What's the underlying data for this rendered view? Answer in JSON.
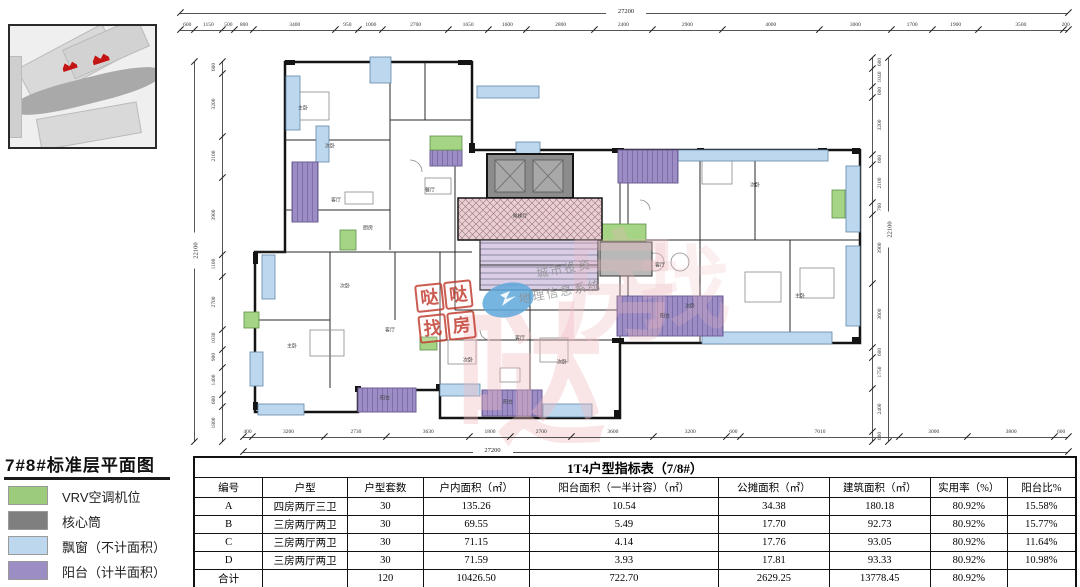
{
  "legend": {
    "title": "7#8#标准层平面图",
    "items": [
      {
        "label": "VRV空调机位",
        "color": "#9CCB7B"
      },
      {
        "label": "核心筒",
        "color": "#7F7F7F"
      },
      {
        "label": "飘窗（不计面积）",
        "color": "#BDD7EE"
      },
      {
        "label": "阳台（计半面积）",
        "color": "#9C8EC4"
      }
    ]
  },
  "site_map": {
    "highlight_color": "#c41414"
  },
  "plan": {
    "colors": {
      "bay_window": "#BDD7EE",
      "balcony": "#9C8EC4",
      "vrv": "#A5D484",
      "core": "#8C8C8C",
      "wall": "#141414",
      "hall_hatch": "#E9CFD3"
    },
    "dimensions": {
      "top": {
        "total": "27200",
        "segments": [
          "600",
          "1150",
          "500",
          "800",
          "3400",
          "950",
          "1000",
          "2700",
          "1650",
          "1600",
          "2800",
          "2400",
          "2900",
          "4000",
          "3000",
          "1700",
          "1900",
          "3500",
          "200"
        ]
      },
      "bottom": {
        "total": "27200",
        "segments": [
          "400",
          "3200",
          "2730",
          "3630",
          "1800",
          "2700",
          "3600",
          "3200",
          "600",
          "7010",
          "3000",
          "3800",
          "600"
        ]
      },
      "left": {
        "total": "22100",
        "segments": [
          "600",
          "3200",
          "2100",
          "3900",
          "1100",
          "2700",
          "1030",
          "900",
          "1400",
          "600",
          "1800"
        ]
      },
      "right": {
        "total": "22100",
        "segments": [
          "600",
          "1040",
          "600",
          "3200",
          "600",
          "2100",
          "700",
          "3900",
          "3600",
          "600",
          "1750",
          "2400",
          "600"
        ]
      }
    },
    "room_labels": [
      {
        "t": "主卧",
        "x": 303,
        "y": 108
      },
      {
        "t": "次卧",
        "x": 330,
        "y": 146
      },
      {
        "t": "客厅",
        "x": 336,
        "y": 200
      },
      {
        "t": "厨房",
        "x": 368,
        "y": 228
      },
      {
        "t": "餐厅",
        "x": 430,
        "y": 190
      },
      {
        "t": "候梯厅",
        "x": 520,
        "y": 216
      },
      {
        "t": "次卧",
        "x": 755,
        "y": 185
      },
      {
        "t": "客厅",
        "x": 660,
        "y": 265
      },
      {
        "t": "次卧",
        "x": 690,
        "y": 306
      },
      {
        "t": "主卧",
        "x": 800,
        "y": 296
      },
      {
        "t": "阳台",
        "x": 665,
        "y": 316
      },
      {
        "t": "主卧",
        "x": 292,
        "y": 346
      },
      {
        "t": "次卧",
        "x": 345,
        "y": 286
      },
      {
        "t": "客厅",
        "x": 390,
        "y": 330
      },
      {
        "t": "次卧",
        "x": 468,
        "y": 360
      },
      {
        "t": "客厅",
        "x": 520,
        "y": 338
      },
      {
        "t": "次卧",
        "x": 562,
        "y": 362
      },
      {
        "t": "阳台",
        "x": 385,
        "y": 398
      },
      {
        "t": "阳台",
        "x": 508,
        "y": 402
      }
    ],
    "watermarks": {
      "stamp_chars": [
        "哒",
        "哒",
        "找",
        "房"
      ],
      "gis_line1": "城市投资",
      "gis_line2": "地理信息系统"
    }
  },
  "table": {
    "title": "1T4户型指标表（7/8#）",
    "headers": [
      "编号",
      "户型",
      "户型套数",
      "户内面积（㎡）",
      "阳台面积（一半计容）（㎡）",
      "公摊面积（㎡）",
      "建筑面积（㎡）",
      "实用率（%）",
      "阳台比%"
    ],
    "rows": [
      [
        "A",
        "四房两厅三卫",
        "30",
        "135.26",
        "10.54",
        "34.38",
        "180.18",
        "80.92%",
        "15.58%"
      ],
      [
        "B",
        "三房两厅两卫",
        "30",
        "69.55",
        "5.49",
        "17.70",
        "92.73",
        "80.92%",
        "15.77%"
      ],
      [
        "C",
        "三房两厅两卫",
        "30",
        "71.15",
        "4.14",
        "17.76",
        "93.05",
        "80.92%",
        "11.64%"
      ],
      [
        "D",
        "三房两厅两卫",
        "30",
        "71.59",
        "3.93",
        "17.81",
        "93.33",
        "80.92%",
        "10.98%"
      ],
      [
        "合计",
        "",
        "120",
        "10426.50",
        "722.70",
        "2629.25",
        "13778.45",
        "80.92%",
        ""
      ]
    ]
  }
}
